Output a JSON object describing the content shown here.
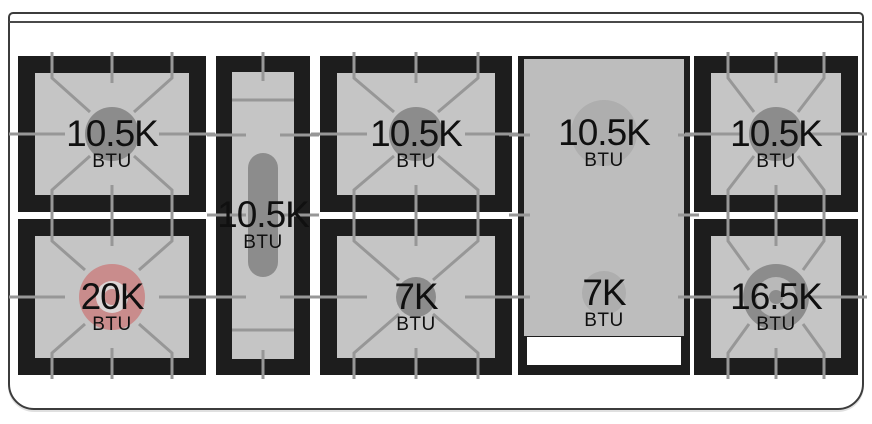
{
  "figure": {
    "name": "range-cooktop-burner-layout-diagram",
    "unit": "BTU",
    "canvas": {
      "width": 872,
      "height": 424,
      "background": "#ffffff"
    },
    "outline_stroke": "#3c3c3c",
    "colors": {
      "frame": "#1d1d1d",
      "surface": "#c5c5c5",
      "grate_line": "#979797",
      "burner": "#8c8c8c",
      "griddle": "#bdbdbd",
      "griddle_burner": "#aeaeae",
      "highlight": "#c98c8c",
      "highlight_inner": "#dcd6d6",
      "ring_mid": "#b9b9b9",
      "handle": "#ffffff",
      "text": "#101010"
    },
    "stations": [
      {
        "id": "rear-left",
        "kind": "square",
        "x": 18,
        "y": 56,
        "w": 188,
        "h": 156,
        "value": "10.5K",
        "burner": {
          "style": "disc",
          "r": 27
        }
      },
      {
        "id": "front-left",
        "kind": "square",
        "x": 18,
        "y": 219,
        "w": 188,
        "h": 156,
        "value": "20K",
        "burner": {
          "style": "ring-highlight",
          "r": 33,
          "r_mid": 16,
          "r_dot": 8
        }
      },
      {
        "id": "center-oval",
        "kind": "oval",
        "x": 216,
        "y": 56,
        "w": 94,
        "h": 319,
        "value": "10.5K",
        "burner": {
          "style": "pill",
          "pw": 30,
          "ph": 124
        }
      },
      {
        "id": "rear-center",
        "kind": "square",
        "x": 320,
        "y": 56,
        "w": 192,
        "h": 156,
        "value": "10.5K",
        "burner": {
          "style": "disc",
          "r": 27
        }
      },
      {
        "id": "front-center",
        "kind": "square",
        "x": 320,
        "y": 219,
        "w": 192,
        "h": 156,
        "value": "7K",
        "burner": {
          "style": "disc",
          "r": 20
        }
      },
      {
        "id": "griddle",
        "kind": "griddle",
        "x": 518,
        "y": 56,
        "w": 172,
        "h": 319,
        "burners": [
          {
            "value": "10.5K",
            "cy": 77,
            "r": 33
          },
          {
            "value": "7K",
            "cy": 237,
            "r": 22
          }
        ]
      },
      {
        "id": "rear-right",
        "kind": "square",
        "x": 694,
        "y": 56,
        "w": 164,
        "h": 156,
        "value": "10.5K",
        "burner": {
          "style": "disc",
          "r": 27
        }
      },
      {
        "id": "front-right",
        "kind": "square",
        "x": 694,
        "y": 219,
        "w": 164,
        "h": 156,
        "value": "16.5K",
        "burner": {
          "style": "ring",
          "r": 33,
          "r_mid": 20,
          "r_dot": 7
        }
      }
    ]
  }
}
